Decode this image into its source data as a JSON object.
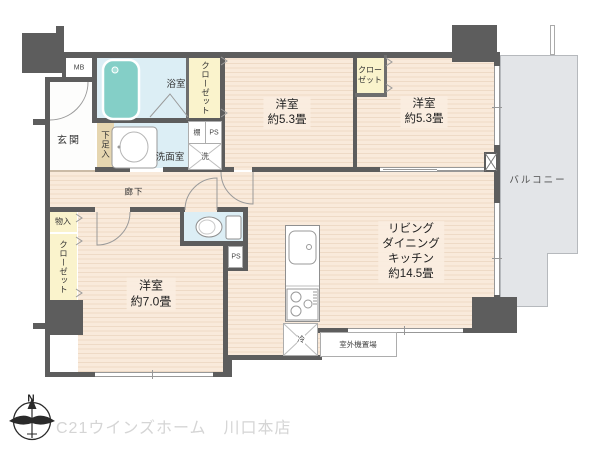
{
  "rooms": {
    "genkan": {
      "label": "玄関"
    },
    "mb": {
      "label": "MB"
    },
    "bathroom": {
      "label": "浴室"
    },
    "washroom": {
      "label": "洗面室"
    },
    "shelf": {
      "label": "棚"
    },
    "ps_upper": {
      "label": "PS"
    },
    "washer": {
      "label": "洗"
    },
    "shoe_box": {
      "label": "下足入"
    },
    "closet_bath": {
      "label": "クローゼット"
    },
    "bedroom_a": {
      "label": "洋室",
      "size": "約5.3畳"
    },
    "closet_mid": {
      "line1": "クロー",
      "line2": "ゼット"
    },
    "bedroom_b": {
      "label": "洋室",
      "size": "約5.3畳"
    },
    "balcony": {
      "label": "バルコニー"
    },
    "corridor": {
      "label": "廊下"
    },
    "storage": {
      "label": "物入"
    },
    "closet_west": {
      "label": "クローゼット"
    },
    "bedroom_c": {
      "label": "洋室",
      "size": "約7.0畳"
    },
    "ps_lower": {
      "label": "PS"
    },
    "ldk": {
      "line1": "リビング",
      "line2": "ダイニング",
      "line3": "キッチン",
      "size": "約14.5畳"
    },
    "refrigerator": {
      "label": "冷"
    },
    "outdoor_unit": {
      "label": "室外機置場"
    }
  },
  "footer": {
    "compass_north": "N",
    "watermark": "C21ウインズホーム　川口本店"
  },
  "colors": {
    "wall": "#5d5d5d",
    "flooring": "#f9eadb",
    "flooring_stripe": "#eedac6",
    "wet_area": "#dceef5",
    "closet": "#faf3cc",
    "shoe_storage": "#e6d6b0",
    "bathtub": "#84cfc7",
    "balcony": "#e3e5e8",
    "watermark_text": "#d5d5d5"
  }
}
